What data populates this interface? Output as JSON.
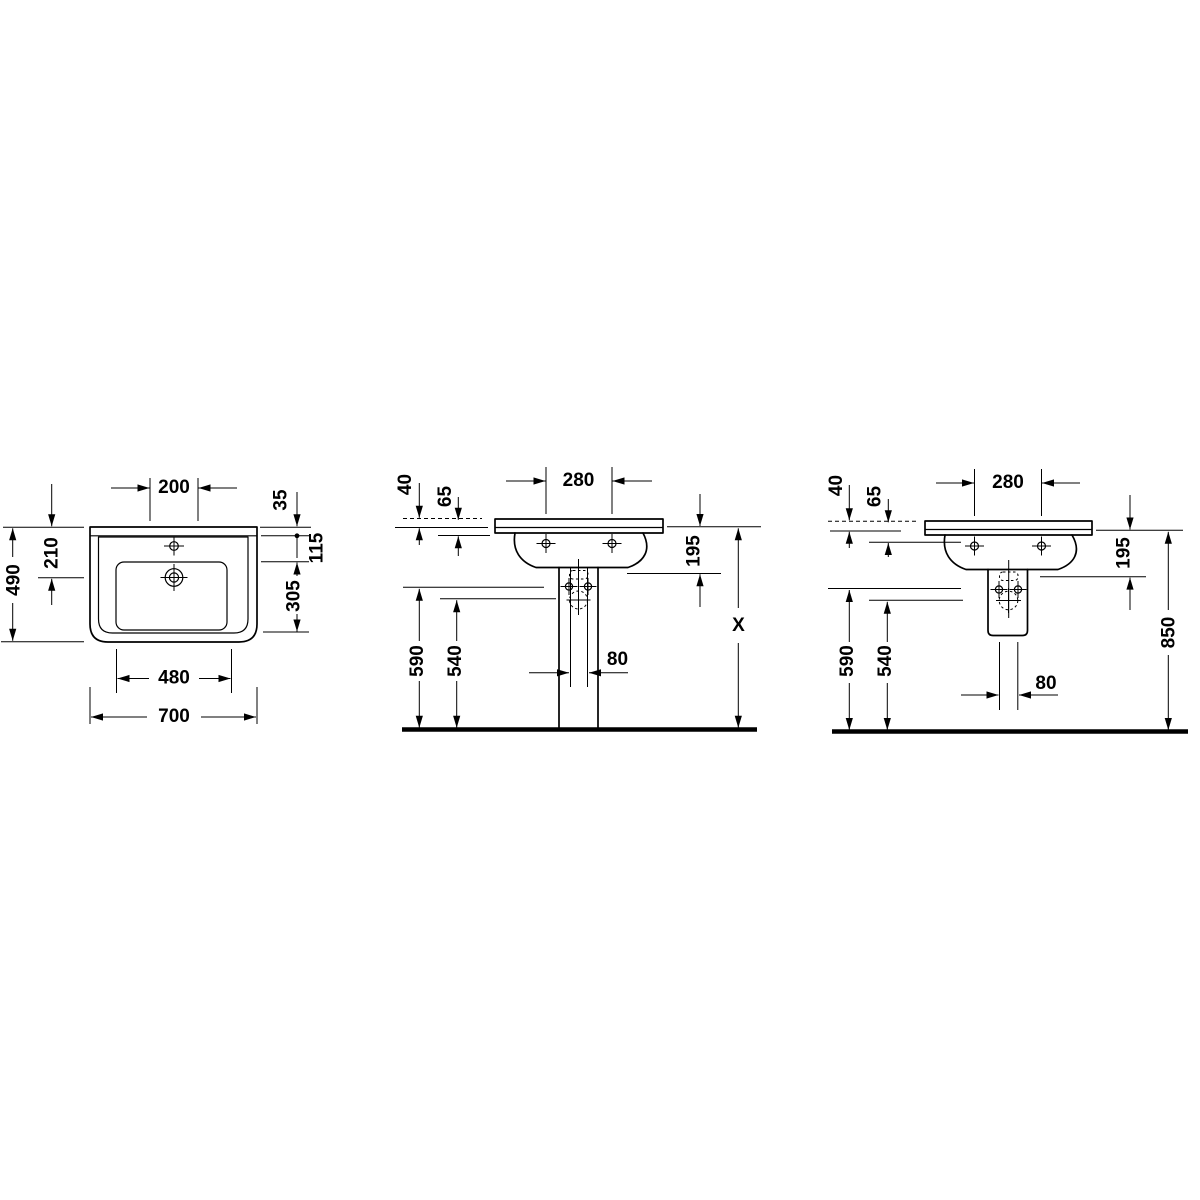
{
  "drawing": {
    "title": "Washbasin technical dimension drawing",
    "type": "technical-dimension-drawing",
    "colors": {
      "line": "#000000",
      "background": "#ffffff"
    },
    "views": {
      "top": {
        "label": "plan view",
        "dims": {
          "tap_spacing": "200",
          "rim_lip": "35",
          "rim_to_bowl": "115",
          "bowl_depth": "305",
          "drain_from_back": "210",
          "overall_depth": "490",
          "bowl_width": "480",
          "overall_width": "700"
        }
      },
      "front_pedestal": {
        "label": "front view with pedestal",
        "dims": {
          "tap_spacing": "280",
          "rim_top": "40",
          "rim_face": "65",
          "outlet_drop": "195",
          "fix_lower": "590",
          "fix_upper": "540",
          "outlet_width": "80",
          "install_height": "X"
        }
      },
      "front_semi": {
        "label": "front view with semi-pedestal",
        "dims": {
          "tap_spacing": "280",
          "rim_top": "40",
          "rim_face": "65",
          "outlet_drop": "195",
          "fix_lower": "590",
          "fix_upper": "540",
          "outlet_width": "80",
          "rim_height": "850"
        }
      }
    }
  }
}
